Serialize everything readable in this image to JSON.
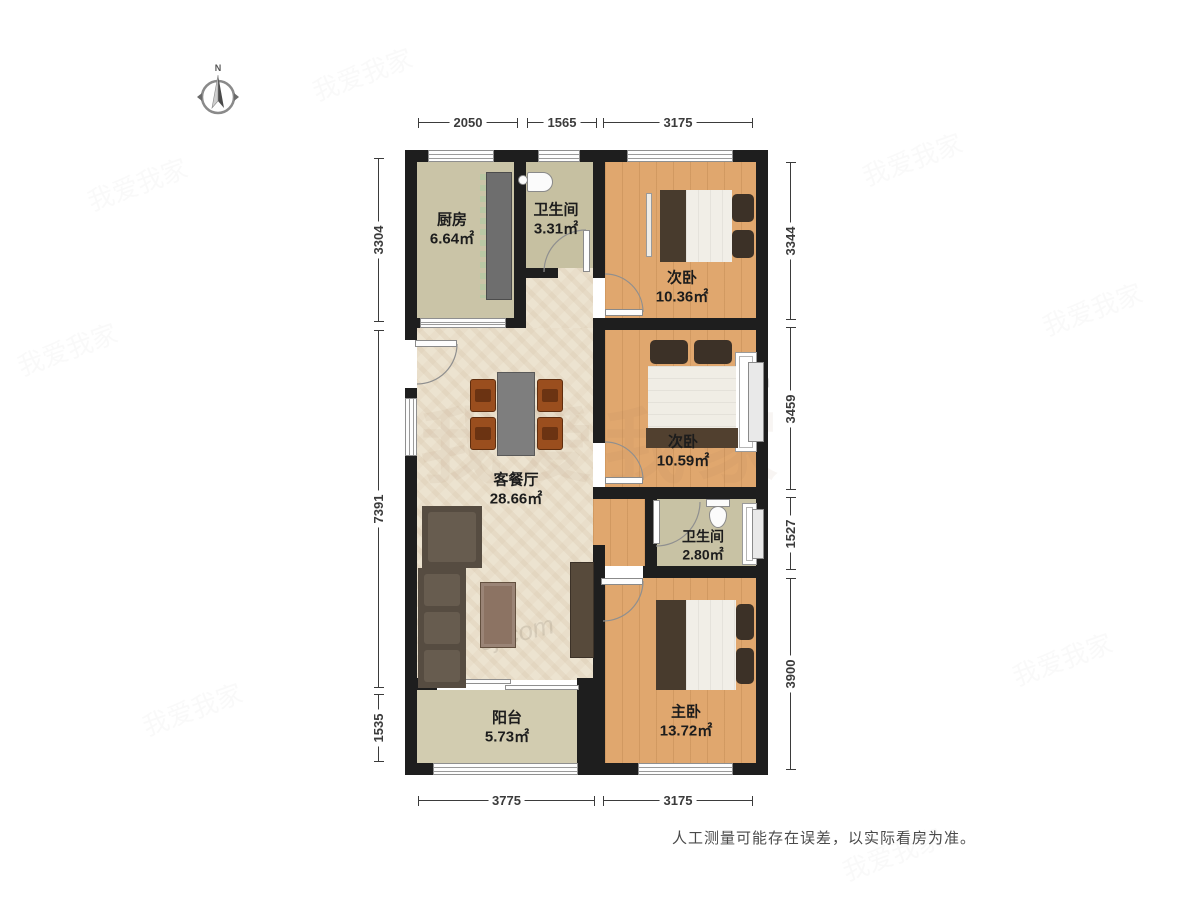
{
  "compass": {
    "north_label": "N"
  },
  "rooms": [
    {
      "name": "厨房",
      "area": "6.64㎡"
    },
    {
      "name": "卫生间",
      "area": "3.31㎡"
    },
    {
      "name": "次卧",
      "area": "10.36㎡"
    },
    {
      "name": "次卧",
      "area": "10.59㎡"
    },
    {
      "name": "客餐厅",
      "area": "28.66㎡"
    },
    {
      "name": "卫生间",
      "area": "2.80㎡"
    },
    {
      "name": "主卧",
      "area": "13.72㎡"
    },
    {
      "name": "阳台",
      "area": "5.73㎡"
    }
  ],
  "dimensions": {
    "top": [
      "2050",
      "1565",
      "3175"
    ],
    "bottom": [
      "3775",
      "3175"
    ],
    "left": [
      "3304",
      "7391",
      "1535"
    ],
    "right": [
      "3344",
      "3459",
      "1527",
      "3900"
    ]
  },
  "footer": {
    "disclaimer": "人工测量可能存在误差，以实际看房为准。"
  },
  "watermarks": {
    "site": "5j.com",
    "brand": "我爱我家"
  },
  "colors": {
    "wall": "#1e1e1e",
    "wood_floor": "#e0a76e",
    "tile_floor": "#cac4a7",
    "marble_floor": "#ece3d0",
    "dimension_text": "#3b3b3b"
  }
}
